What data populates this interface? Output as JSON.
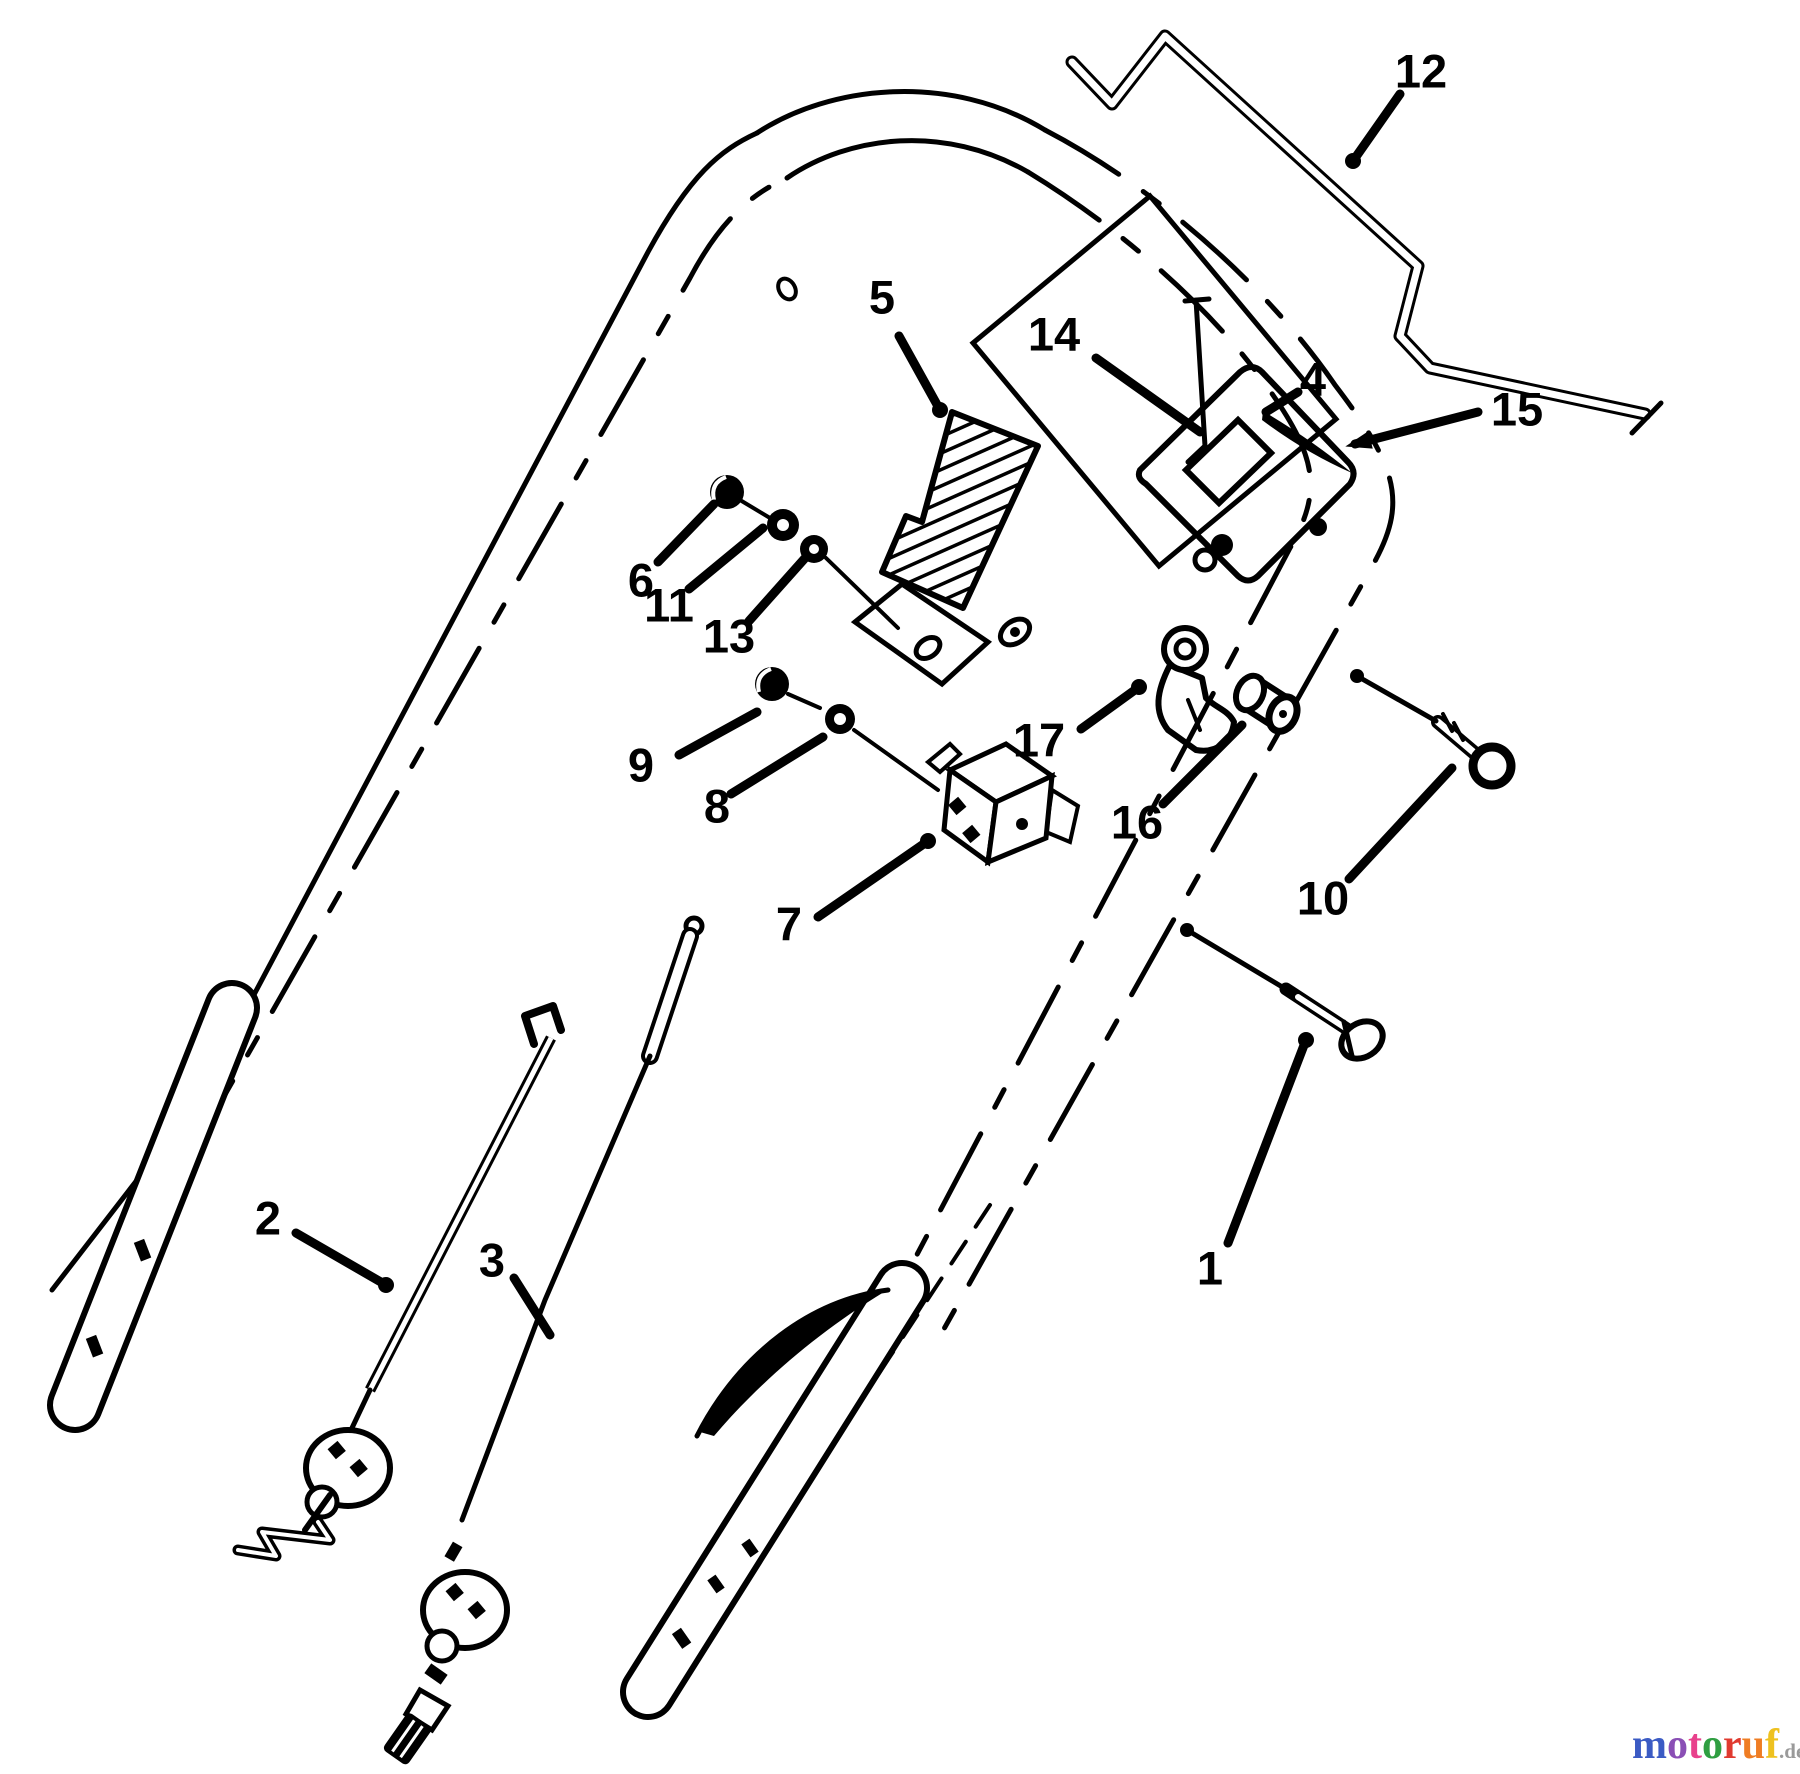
{
  "diagram": {
    "background_color": "#ffffff",
    "ink_color": "#000000",
    "callouts": [
      {
        "id": "1",
        "label": "1",
        "x": 1210,
        "y": 1268,
        "leader": [
          1228,
          1243,
          1306,
          1040
        ],
        "end": "dot"
      },
      {
        "id": "2",
        "label": "2",
        "x": 268,
        "y": 1218,
        "leader": [
          296,
          1233,
          386,
          1285
        ],
        "end": "dot"
      },
      {
        "id": "3",
        "label": "3",
        "x": 492,
        "y": 1260,
        "leader": [
          514,
          1278,
          550,
          1335
        ],
        "end": "none"
      },
      {
        "id": "4",
        "label": "4",
        "x": 1313,
        "y": 379,
        "leader": [
          1298,
          392,
          1266,
          412
        ],
        "end": "none"
      },
      {
        "id": "5",
        "label": "5",
        "x": 882,
        "y": 297,
        "leader": [
          899,
          336,
          940,
          410
        ],
        "end": "dot"
      },
      {
        "id": "6",
        "label": "6",
        "x": 641,
        "y": 580,
        "leader": [
          658,
          562,
          714,
          504
        ],
        "end": "none"
      },
      {
        "id": "7",
        "label": "7",
        "x": 789,
        "y": 924,
        "leader": [
          818,
          917,
          928,
          841
        ],
        "end": "dot"
      },
      {
        "id": "8",
        "label": "8",
        "x": 717,
        "y": 806,
        "leader": [
          731,
          794,
          823,
          737
        ],
        "end": "none"
      },
      {
        "id": "9",
        "label": "9",
        "x": 641,
        "y": 765,
        "leader": [
          679,
          755,
          757,
          712
        ],
        "end": "none"
      },
      {
        "id": "10",
        "label": "10",
        "x": 1323,
        "y": 898,
        "leader": [
          1349,
          879,
          1452,
          768
        ],
        "end": "none"
      },
      {
        "id": "11",
        "label": "11",
        "x": 669,
        "y": 605,
        "leader": [
          689,
          589,
          763,
          528
        ],
        "end": "none"
      },
      {
        "id": "12",
        "label": "12",
        "x": 1421,
        "y": 71,
        "leader": [
          1400,
          94,
          1353,
          161
        ],
        "end": "dot"
      },
      {
        "id": "13",
        "label": "13",
        "x": 729,
        "y": 636,
        "leader": [
          749,
          621,
          806,
          557
        ],
        "end": "none"
      },
      {
        "id": "14",
        "label": "14",
        "x": 1054,
        "y": 334,
        "leader": [
          1096,
          358,
          1200,
          432
        ],
        "end": "none"
      },
      {
        "id": "15",
        "label": "15",
        "x": 1517,
        "y": 409,
        "leader": [
          1478,
          412,
          1355,
          444
        ],
        "end": "arrow"
      },
      {
        "id": "16",
        "label": "16",
        "x": 1137,
        "y": 822,
        "leader": [
          1163,
          804,
          1242,
          725
        ],
        "end": "none"
      },
      {
        "id": "17",
        "label": "17",
        "x": 1039,
        "y": 740,
        "leader": [
          1081,
          729,
          1139,
          687
        ],
        "end": "dot"
      }
    ],
    "assembly_lines": [
      {
        "x1": 1187,
        "y1": 930,
        "x2": 1284,
        "y2": 988
      },
      {
        "x1": 1357,
        "y1": 676,
        "x2": 1436,
        "y2": 721
      }
    ]
  },
  "watermark": {
    "word": [
      {
        "ch": "m",
        "color": "#3b5bc4"
      },
      {
        "ch": "o",
        "color": "#8a4fb5"
      },
      {
        "ch": "t",
        "color": "#e8418c"
      },
      {
        "ch": "o",
        "color": "#2f9e41"
      },
      {
        "ch": "r",
        "color": "#e03a2f"
      },
      {
        "ch": "u",
        "color": "#ef7d23"
      },
      {
        "ch": "f",
        "color": "#eec11f"
      }
    ],
    "suffix": ".de",
    "suffix_color": "#9a9a9a"
  }
}
